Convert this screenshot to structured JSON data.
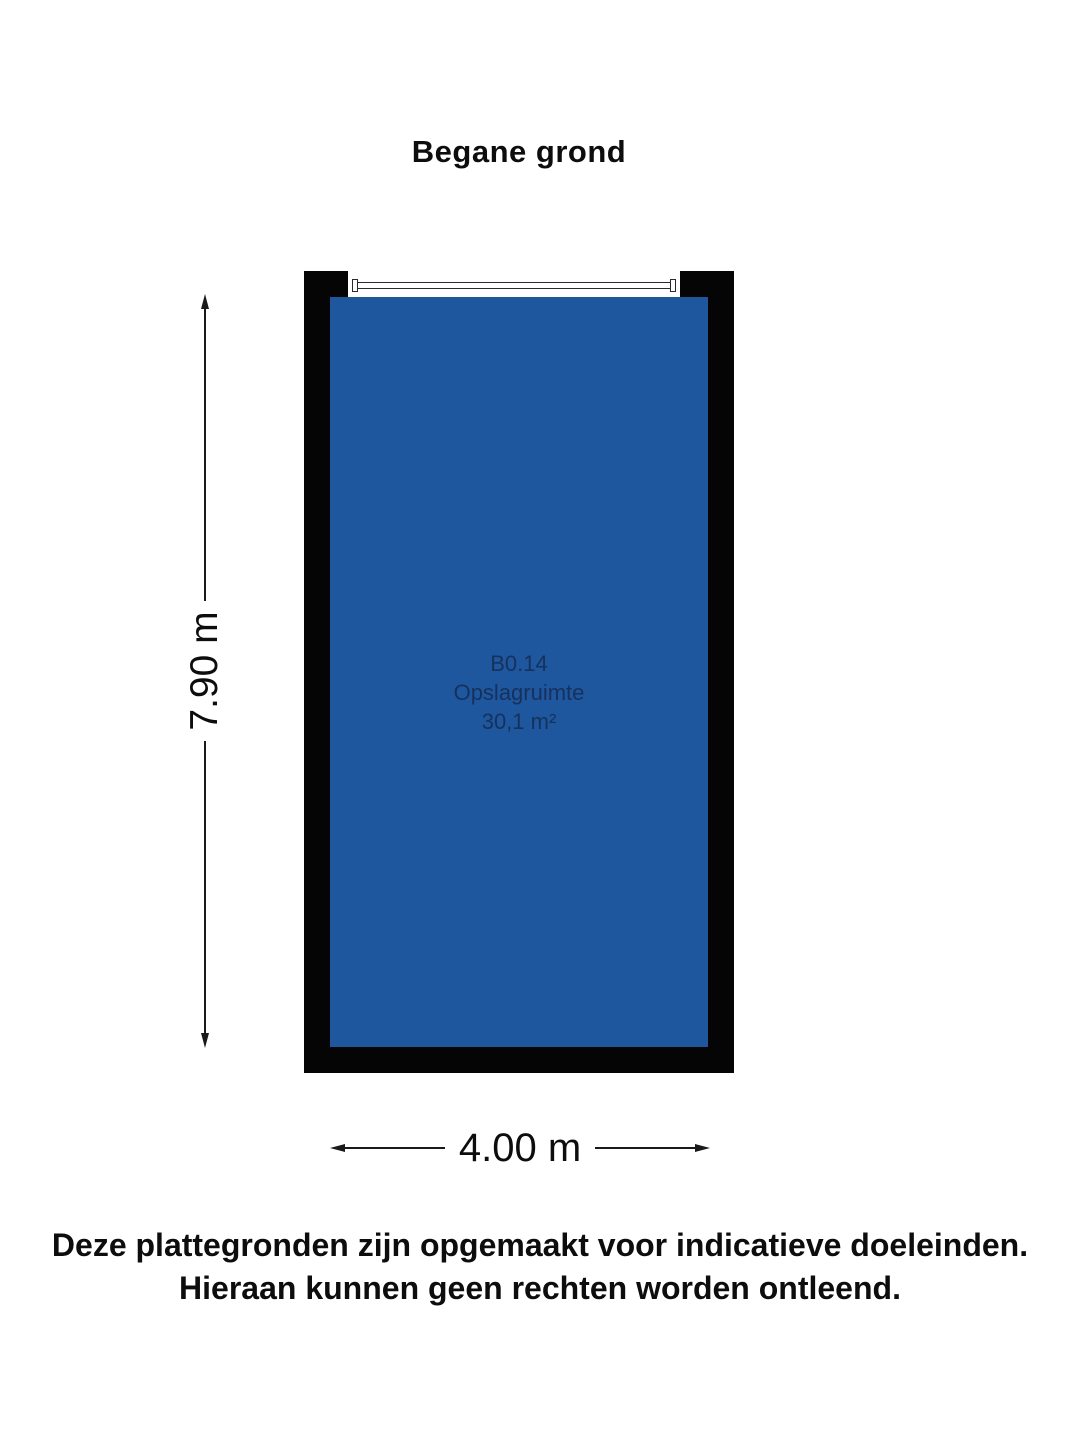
{
  "title": "Begane grond",
  "floorplan": {
    "room": {
      "code": "B0.14",
      "name": "Opslagruimte",
      "area": "30,1 m²"
    },
    "dimensions": {
      "vertical": "7.90 m",
      "horizontal": "4.00 m"
    },
    "features": [
      "window-opening-top-wall"
    ]
  },
  "disclaimer": {
    "line1": "Deze plattegronden zijn opgemaakt voor indicatieve doeleinden.",
    "line2": "Hieraan kunnen geen rechten worden ontleend."
  },
  "colors": {
    "wall": "#050505",
    "room_fill": "#1e579e",
    "room_label": "#16315e",
    "line": "#1a1a1a",
    "background": "#ffffff"
  }
}
